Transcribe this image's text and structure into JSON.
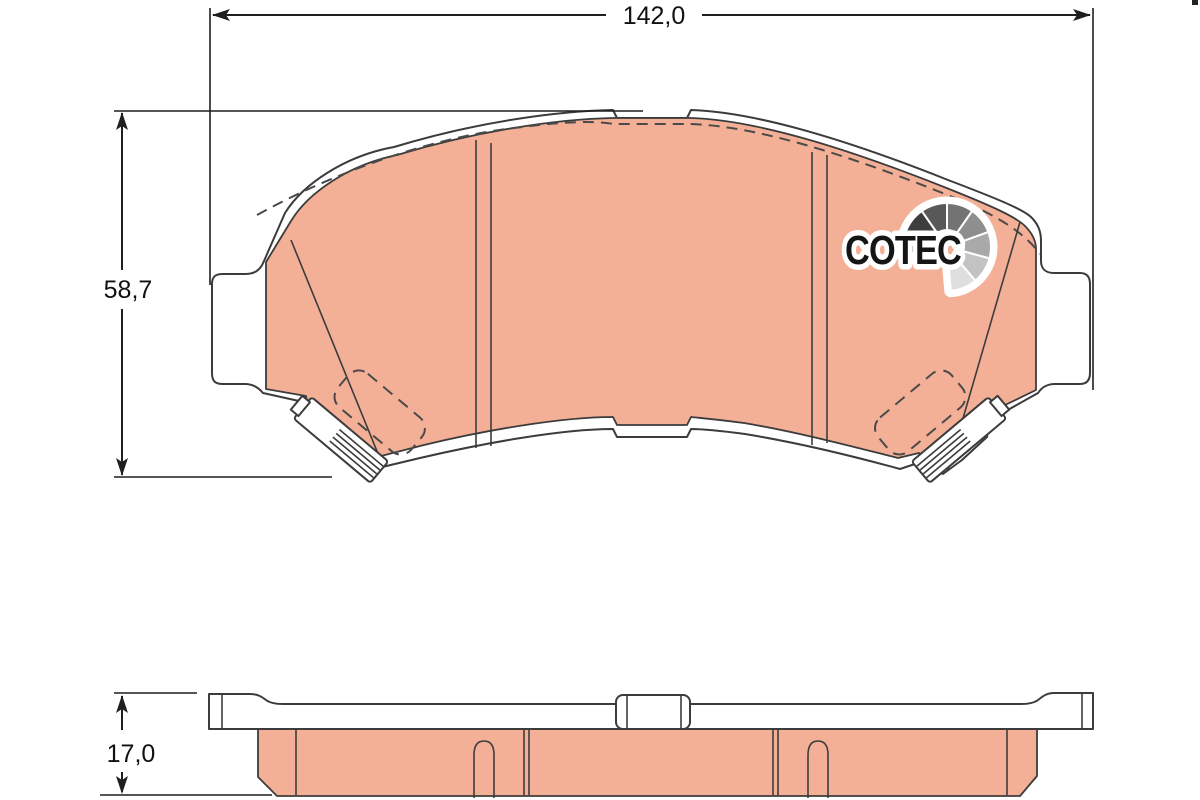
{
  "drawing": {
    "width_dim": "142,0",
    "height_dim": "58,7",
    "thickness_dim": "17,0"
  },
  "logo": {
    "text": "COTEC",
    "text_color": "#151515",
    "halo_color": "#ffffff",
    "fan_colors": [
      "#1a1a1a",
      "#3d3d3d",
      "#585858",
      "#737373",
      "#8e8e8e",
      "#a9a9a9",
      "#c3c3c3",
      "#dedede"
    ]
  },
  "colors": {
    "background": "#ffffff",
    "friction_material": "#f4b096",
    "outline": "#3c3c3c",
    "dimension_lines": "#1f1f1f"
  }
}
